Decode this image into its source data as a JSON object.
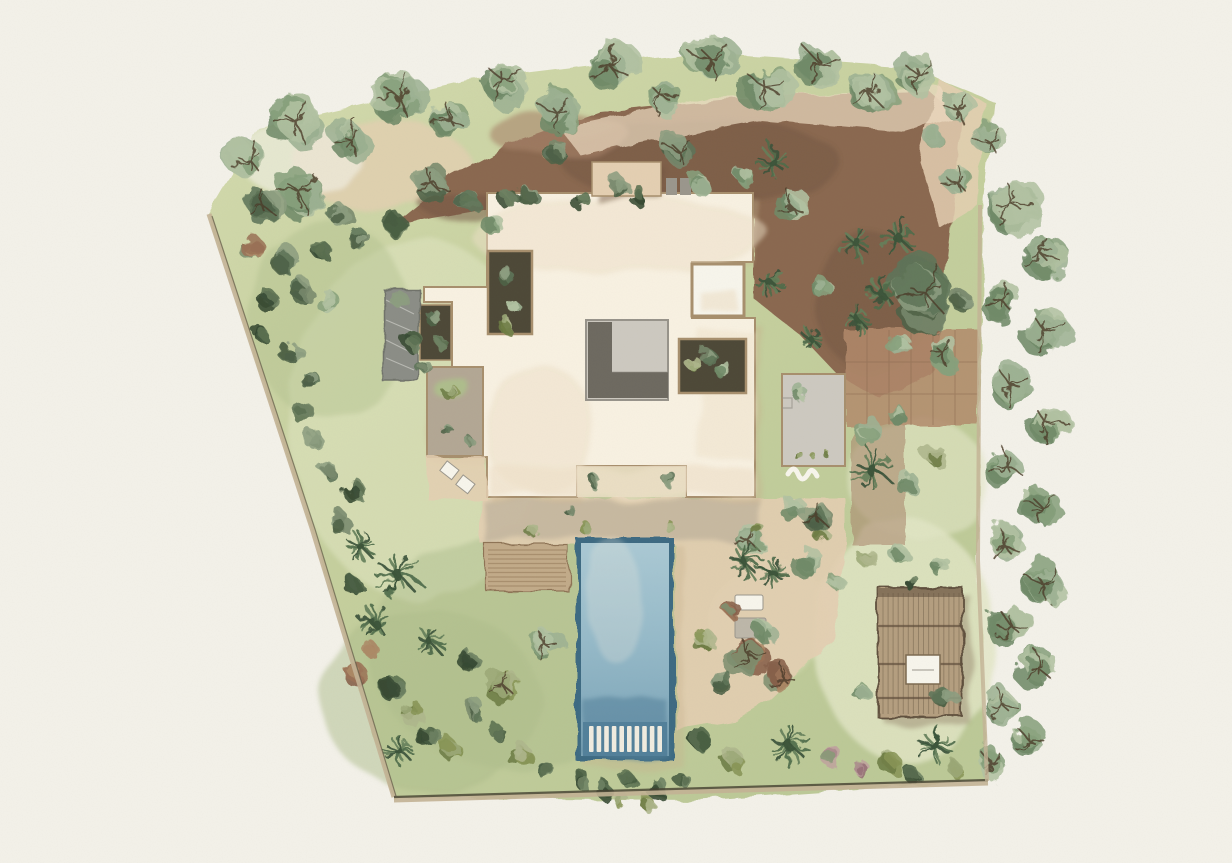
{
  "scene": {
    "kind": "watercolor-landscape-site-plan",
    "features": [
      "villa-roof",
      "swimming-pool",
      "wooden-deck",
      "pergola",
      "lawn",
      "tree-belt",
      "gravel-court",
      "tiled-path"
    ]
  },
  "palette": {
    "paper": "#f3f1e9",
    "lawn1": "#d4dbae",
    "lawn2": "#c6d09e",
    "lawn3": "#bcc997",
    "lawnLight": "#dce1ba",
    "lawnDark": "#aebd8c",
    "lawnPale": "#e2e6c6",
    "dirt": "#8a6750",
    "dirtDark": "#6f5340",
    "dirtLight": "#a8846a",
    "sand": "#e4cfb2",
    "sandLight": "#eddcc2",
    "tile": "#b28a6c",
    "tileLine": "#8d6a50",
    "roof": "#f8f1e2",
    "roofWash": "#eee0c8",
    "roofLine": "#a78f6d",
    "wallLine": "#7c6a50",
    "roofShadow": "#c9b28e",
    "slate": "#8b8d86",
    "slateDark": "#6f726b",
    "slateStreak": "#d9d9d2",
    "patioTaupe": "#b3a794",
    "courtLight": "#cdc9c0",
    "courtDark": "#6d6960",
    "courtMid": "#97938a",
    "soil": "#4d4837",
    "poolRim": "#3c6a82",
    "poolSteps": "#52809a",
    "stepWhite": "#f0ece0",
    "wood": "#c2ab89",
    "woodLine": "#8e7354",
    "pergolaWood": "#b49e7f",
    "pergolaLine": "#5f4f3c",
    "white": "#f7f5ec",
    "greyBox": "#9a968c",
    "loungerGrey": "#bdb7a9",
    "boundary": "#c3b295",
    "boundaryDark": "#43402f",
    "branch": "#4b3b28"
  },
  "foliage": {
    "sage": [
      "#9db293",
      "#87a07c",
      "#b2c1a2",
      "#6f8a68"
    ],
    "dark": [
      "#77896c",
      "#5f7458",
      "#8c9d80",
      "#4d6147"
    ],
    "olive": [
      "#9ca878",
      "#879455",
      "#aeb68c",
      "#6d7c44"
    ],
    "darkgreen": [
      "#5b7051",
      "#475c41",
      "#6d8162",
      "#374a33"
    ],
    "red": [
      "#9b7257",
      "#86604a",
      "#ac8a67",
      "#7e9070"
    ],
    "pink": [
      "#ab8a8c",
      "#967076",
      "#bfa39e",
      "#879a76"
    ],
    "palm": [
      "#4f6b4a",
      "#3b5339",
      "#647f5a",
      "#2f452e"
    ]
  },
  "pool": {
    "steps": 10
  },
  "deck": {
    "slats": 9
  },
  "pergola": {
    "slats": 16,
    "beams": 3
  },
  "plants": [
    [
      "t",
      250,
      160,
      26,
      "sage"
    ],
    [
      "t",
      296,
      122,
      30,
      "sage"
    ],
    [
      "t",
      350,
      138,
      24,
      "sage"
    ],
    [
      "t",
      398,
      96,
      30,
      "sage"
    ],
    [
      "t",
      448,
      118,
      22,
      "sage"
    ],
    [
      "t",
      505,
      82,
      28,
      "sage"
    ],
    [
      "t",
      556,
      112,
      24,
      "sage"
    ],
    [
      "t",
      612,
      68,
      30,
      "sage"
    ],
    [
      "t",
      663,
      98,
      22,
      "sage"
    ],
    [
      "t",
      712,
      60,
      28,
      "sage"
    ],
    [
      "t",
      766,
      88,
      28,
      "sage"
    ],
    [
      "t",
      820,
      64,
      26,
      "sage"
    ],
    [
      "t",
      870,
      94,
      26,
      "sage"
    ],
    [
      "t",
      918,
      74,
      24,
      "sage"
    ],
    [
      "t",
      958,
      110,
      22,
      "sage"
    ],
    [
      "t",
      988,
      140,
      20,
      "sage"
    ],
    [
      "t",
      1012,
      205,
      30,
      "sage"
    ],
    [
      "t",
      1042,
      255,
      26,
      "sage"
    ],
    [
      "t",
      1002,
      300,
      22,
      "sage"
    ],
    [
      "t",
      1046,
      332,
      28,
      "sage"
    ],
    [
      "t",
      1010,
      385,
      26,
      "sage"
    ],
    [
      "t",
      1048,
      425,
      24,
      "sage"
    ],
    [
      "t",
      1006,
      465,
      22,
      "sage"
    ],
    [
      "t",
      1040,
      505,
      24,
      "sage"
    ],
    [
      "t",
      1004,
      545,
      22,
      "sage"
    ],
    [
      "t",
      1044,
      585,
      26,
      "sage"
    ],
    [
      "t",
      1010,
      625,
      24,
      "sage"
    ],
    [
      "t",
      1038,
      668,
      22,
      "sage"
    ],
    [
      "t",
      1002,
      705,
      22,
      "sage"
    ],
    [
      "t",
      1028,
      740,
      20,
      "sage"
    ],
    [
      "t",
      990,
      762,
      18,
      "sage"
    ],
    [
      "t",
      300,
      192,
      30,
      "sage"
    ],
    [
      "t",
      262,
      205,
      20,
      "dark"
    ],
    [
      "s",
      340,
      215,
      16,
      "dark"
    ],
    [
      "s",
      250,
      248,
      15,
      "red"
    ],
    [
      "s",
      285,
      262,
      16,
      "dark"
    ],
    [
      "s",
      320,
      250,
      13,
      "darkgreen"
    ],
    [
      "s",
      360,
      240,
      15,
      "dark"
    ],
    [
      "s",
      395,
      225,
      16,
      "darkgreen"
    ],
    [
      "t",
      430,
      182,
      20,
      "dark"
    ],
    [
      "s",
      465,
      200,
      15,
      "dark"
    ],
    [
      "s",
      490,
      222,
      13,
      "sage"
    ],
    [
      "s",
      300,
      290,
      15,
      "dark"
    ],
    [
      "s",
      330,
      305,
      13,
      "sage"
    ],
    [
      "s",
      270,
      300,
      12,
      "darkgreen"
    ],
    [
      "s",
      312,
      380,
      13,
      "dark"
    ],
    [
      "s",
      290,
      352,
      12,
      "dark"
    ],
    [
      "s",
      262,
      330,
      10,
      "darkgreen"
    ],
    [
      "s",
      300,
      410,
      12,
      "darkgreen"
    ],
    [
      "s",
      316,
      440,
      13,
      "dark"
    ],
    [
      "s",
      330,
      470,
      12,
      "dark"
    ],
    [
      "s",
      355,
      490,
      13,
      "darkgreen"
    ],
    [
      "s",
      340,
      520,
      13,
      "dark"
    ],
    [
      "s",
      560,
      150,
      15,
      "dark"
    ],
    [
      "s",
      528,
      196,
      13,
      "dark"
    ],
    [
      "s",
      620,
      186,
      13,
      "dark"
    ],
    [
      "t",
      678,
      150,
      19,
      "dark"
    ],
    [
      "s",
      700,
      185,
      13,
      "sage"
    ],
    [
      "p",
      772,
      162,
      16,
      "palm"
    ],
    [
      "t",
      790,
      205,
      18,
      "sage"
    ],
    [
      "s",
      745,
      175,
      13,
      "sage"
    ],
    [
      "s",
      820,
      285,
      14,
      "sage"
    ],
    [
      "s",
      510,
      200,
      11,
      "darkgreen"
    ],
    [
      "s",
      580,
      198,
      10,
      "darkgreen"
    ],
    [
      "s",
      640,
      198,
      10,
      "darkgreen"
    ],
    [
      "p",
      772,
      285,
      13,
      "palm"
    ],
    [
      "p",
      857,
      243,
      16,
      "palm"
    ],
    [
      "p",
      898,
      238,
      17,
      "palm"
    ],
    [
      "t",
      925,
      292,
      38,
      "dark"
    ],
    [
      "p",
      880,
      292,
      14,
      "palm"
    ],
    [
      "p",
      858,
      320,
      11,
      "palm"
    ],
    [
      "s",
      900,
      347,
      14,
      "sage"
    ],
    [
      "t",
      942,
      352,
      18,
      "sage"
    ],
    [
      "t",
      955,
      180,
      18,
      "sage"
    ],
    [
      "s",
      935,
      140,
      15,
      "sage"
    ],
    [
      "s",
      962,
      300,
      13,
      "dark"
    ],
    [
      "p",
      812,
      340,
      10,
      "palm"
    ],
    [
      "s",
      865,
      430,
      15,
      "sage"
    ],
    [
      "s",
      900,
      415,
      13,
      "sage"
    ],
    [
      "p",
      872,
      470,
      20,
      "palm"
    ],
    [
      "s",
      905,
      482,
      13,
      "sage"
    ],
    [
      "s",
      936,
      455,
      13,
      "olive"
    ],
    [
      "s",
      792,
      510,
      13,
      "sage"
    ],
    [
      "s",
      820,
      532,
      11,
      "olive"
    ],
    [
      "t",
      748,
      540,
      19,
      "sage"
    ],
    [
      "p",
      745,
      562,
      15,
      "palm"
    ],
    [
      "p",
      772,
      572,
      14,
      "palm"
    ],
    [
      "t",
      806,
      560,
      17,
      "sage"
    ],
    [
      "t",
      815,
      515,
      18,
      "dark"
    ],
    [
      "s",
      836,
      585,
      11,
      "sage"
    ],
    [
      "t",
      748,
      655,
      24,
      "red"
    ],
    [
      "t",
      782,
      678,
      19,
      "red"
    ],
    [
      "s",
      722,
      682,
      14,
      "dark"
    ],
    [
      "s",
      705,
      640,
      13,
      "olive"
    ],
    [
      "s",
      764,
      630,
      13,
      "sage"
    ],
    [
      "s",
      730,
      610,
      11,
      "red"
    ],
    [
      "s",
      700,
      740,
      16,
      "darkgreen"
    ],
    [
      "s",
      735,
      762,
      14,
      "olive"
    ],
    [
      "p",
      790,
      746,
      18,
      "palm"
    ],
    [
      "s",
      830,
      756,
      13,
      "pink"
    ],
    [
      "s",
      860,
      770,
      11,
      "pink"
    ],
    [
      "s",
      890,
      762,
      13,
      "olive"
    ],
    [
      "p",
      936,
      746,
      17,
      "palm"
    ],
    [
      "s",
      912,
      773,
      11,
      "darkgreen"
    ],
    [
      "s",
      956,
      770,
      11,
      "olive"
    ],
    [
      "s",
      945,
      696,
      14,
      "dark"
    ],
    [
      "s",
      862,
      692,
      11,
      "sage"
    ],
    [
      "s",
      868,
      560,
      11,
      "olive"
    ],
    [
      "s",
      900,
      556,
      11,
      "sage"
    ],
    [
      "s",
      940,
      566,
      12,
      "sage"
    ],
    [
      "s",
      912,
      584,
      9,
      "darkgreen"
    ],
    [
      "t",
      545,
      645,
      19,
      "sage"
    ],
    [
      "t",
      502,
      684,
      19,
      "olive"
    ],
    [
      "s",
      470,
      662,
      12,
      "darkgreen"
    ],
    [
      "p",
      430,
      642,
      13,
      "palm"
    ],
    [
      "p",
      398,
      575,
      20,
      "palm"
    ],
    [
      "p",
      360,
      546,
      13,
      "palm"
    ],
    [
      "p",
      374,
      622,
      15,
      "palm"
    ],
    [
      "s",
      352,
      585,
      12,
      "darkgreen"
    ],
    [
      "s",
      368,
      650,
      12,
      "red"
    ],
    [
      "s",
      352,
      672,
      13,
      "red"
    ],
    [
      "s",
      390,
      690,
      15,
      "darkgreen"
    ],
    [
      "s",
      410,
      712,
      13,
      "olive"
    ],
    [
      "s",
      428,
      735,
      15,
      "darkgreen"
    ],
    [
      "p",
      398,
      750,
      13,
      "palm"
    ],
    [
      "s",
      452,
      748,
      12,
      "olive"
    ],
    [
      "s",
      475,
      712,
      13,
      "dark"
    ],
    [
      "s",
      500,
      735,
      12,
      "darkgreen"
    ],
    [
      "s",
      520,
      756,
      13,
      "olive"
    ],
    [
      "s",
      545,
      770,
      12,
      "darkgreen"
    ],
    [
      "s",
      580,
      778,
      11,
      "darkgreen"
    ],
    [
      "s",
      605,
      788,
      11,
      "darkgreen"
    ],
    [
      "s",
      632,
      782,
      11,
      "darkgreen"
    ],
    [
      "s",
      658,
      788,
      11,
      "darkgreen"
    ],
    [
      "s",
      682,
      780,
      10,
      "darkgreen"
    ],
    [
      "s",
      618,
      800,
      11,
      "olive"
    ],
    [
      "s",
      648,
      804,
      10,
      "olive"
    ],
    [
      "s",
      585,
      528,
      9,
      "olive"
    ],
    [
      "s",
      670,
      528,
      9,
      "olive"
    ],
    [
      "s",
      757,
      528,
      9,
      "olive"
    ],
    [
      "s",
      533,
      530,
      9,
      "olive"
    ],
    [
      "s",
      568,
      512,
      7,
      "dark"
    ],
    [
      "s",
      505,
      275,
      11,
      "dark"
    ],
    [
      "s",
      512,
      305,
      11,
      "sage"
    ],
    [
      "s",
      508,
      324,
      9,
      "olive"
    ],
    [
      "s",
      706,
      355,
      11,
      "dark"
    ],
    [
      "s",
      722,
      370,
      9,
      "sage"
    ],
    [
      "s",
      694,
      366,
      9,
      "olive"
    ],
    [
      "s",
      592,
      480,
      9,
      "dark"
    ],
    [
      "s",
      668,
      481,
      9,
      "dark"
    ],
    [
      "s",
      435,
      318,
      9,
      "dark"
    ],
    [
      "s",
      440,
      344,
      9,
      "darkgreen"
    ],
    [
      "s",
      398,
      300,
      13,
      "dark"
    ],
    [
      "s",
      412,
      340,
      11,
      "darkgreen"
    ],
    [
      "s",
      424,
      368,
      9,
      "dark"
    ],
    [
      "s",
      452,
      392,
      10,
      "olive"
    ],
    [
      "s",
      448,
      430,
      7,
      "dark"
    ],
    [
      "s",
      470,
      441,
      7,
      "dark"
    ],
    [
      "s",
      800,
      392,
      9,
      "sage"
    ],
    [
      "s",
      798,
      455,
      5,
      "olive"
    ],
    [
      "s",
      813,
      456,
      5,
      "olive"
    ],
    [
      "s",
      828,
      455,
      5,
      "olive"
    ]
  ]
}
